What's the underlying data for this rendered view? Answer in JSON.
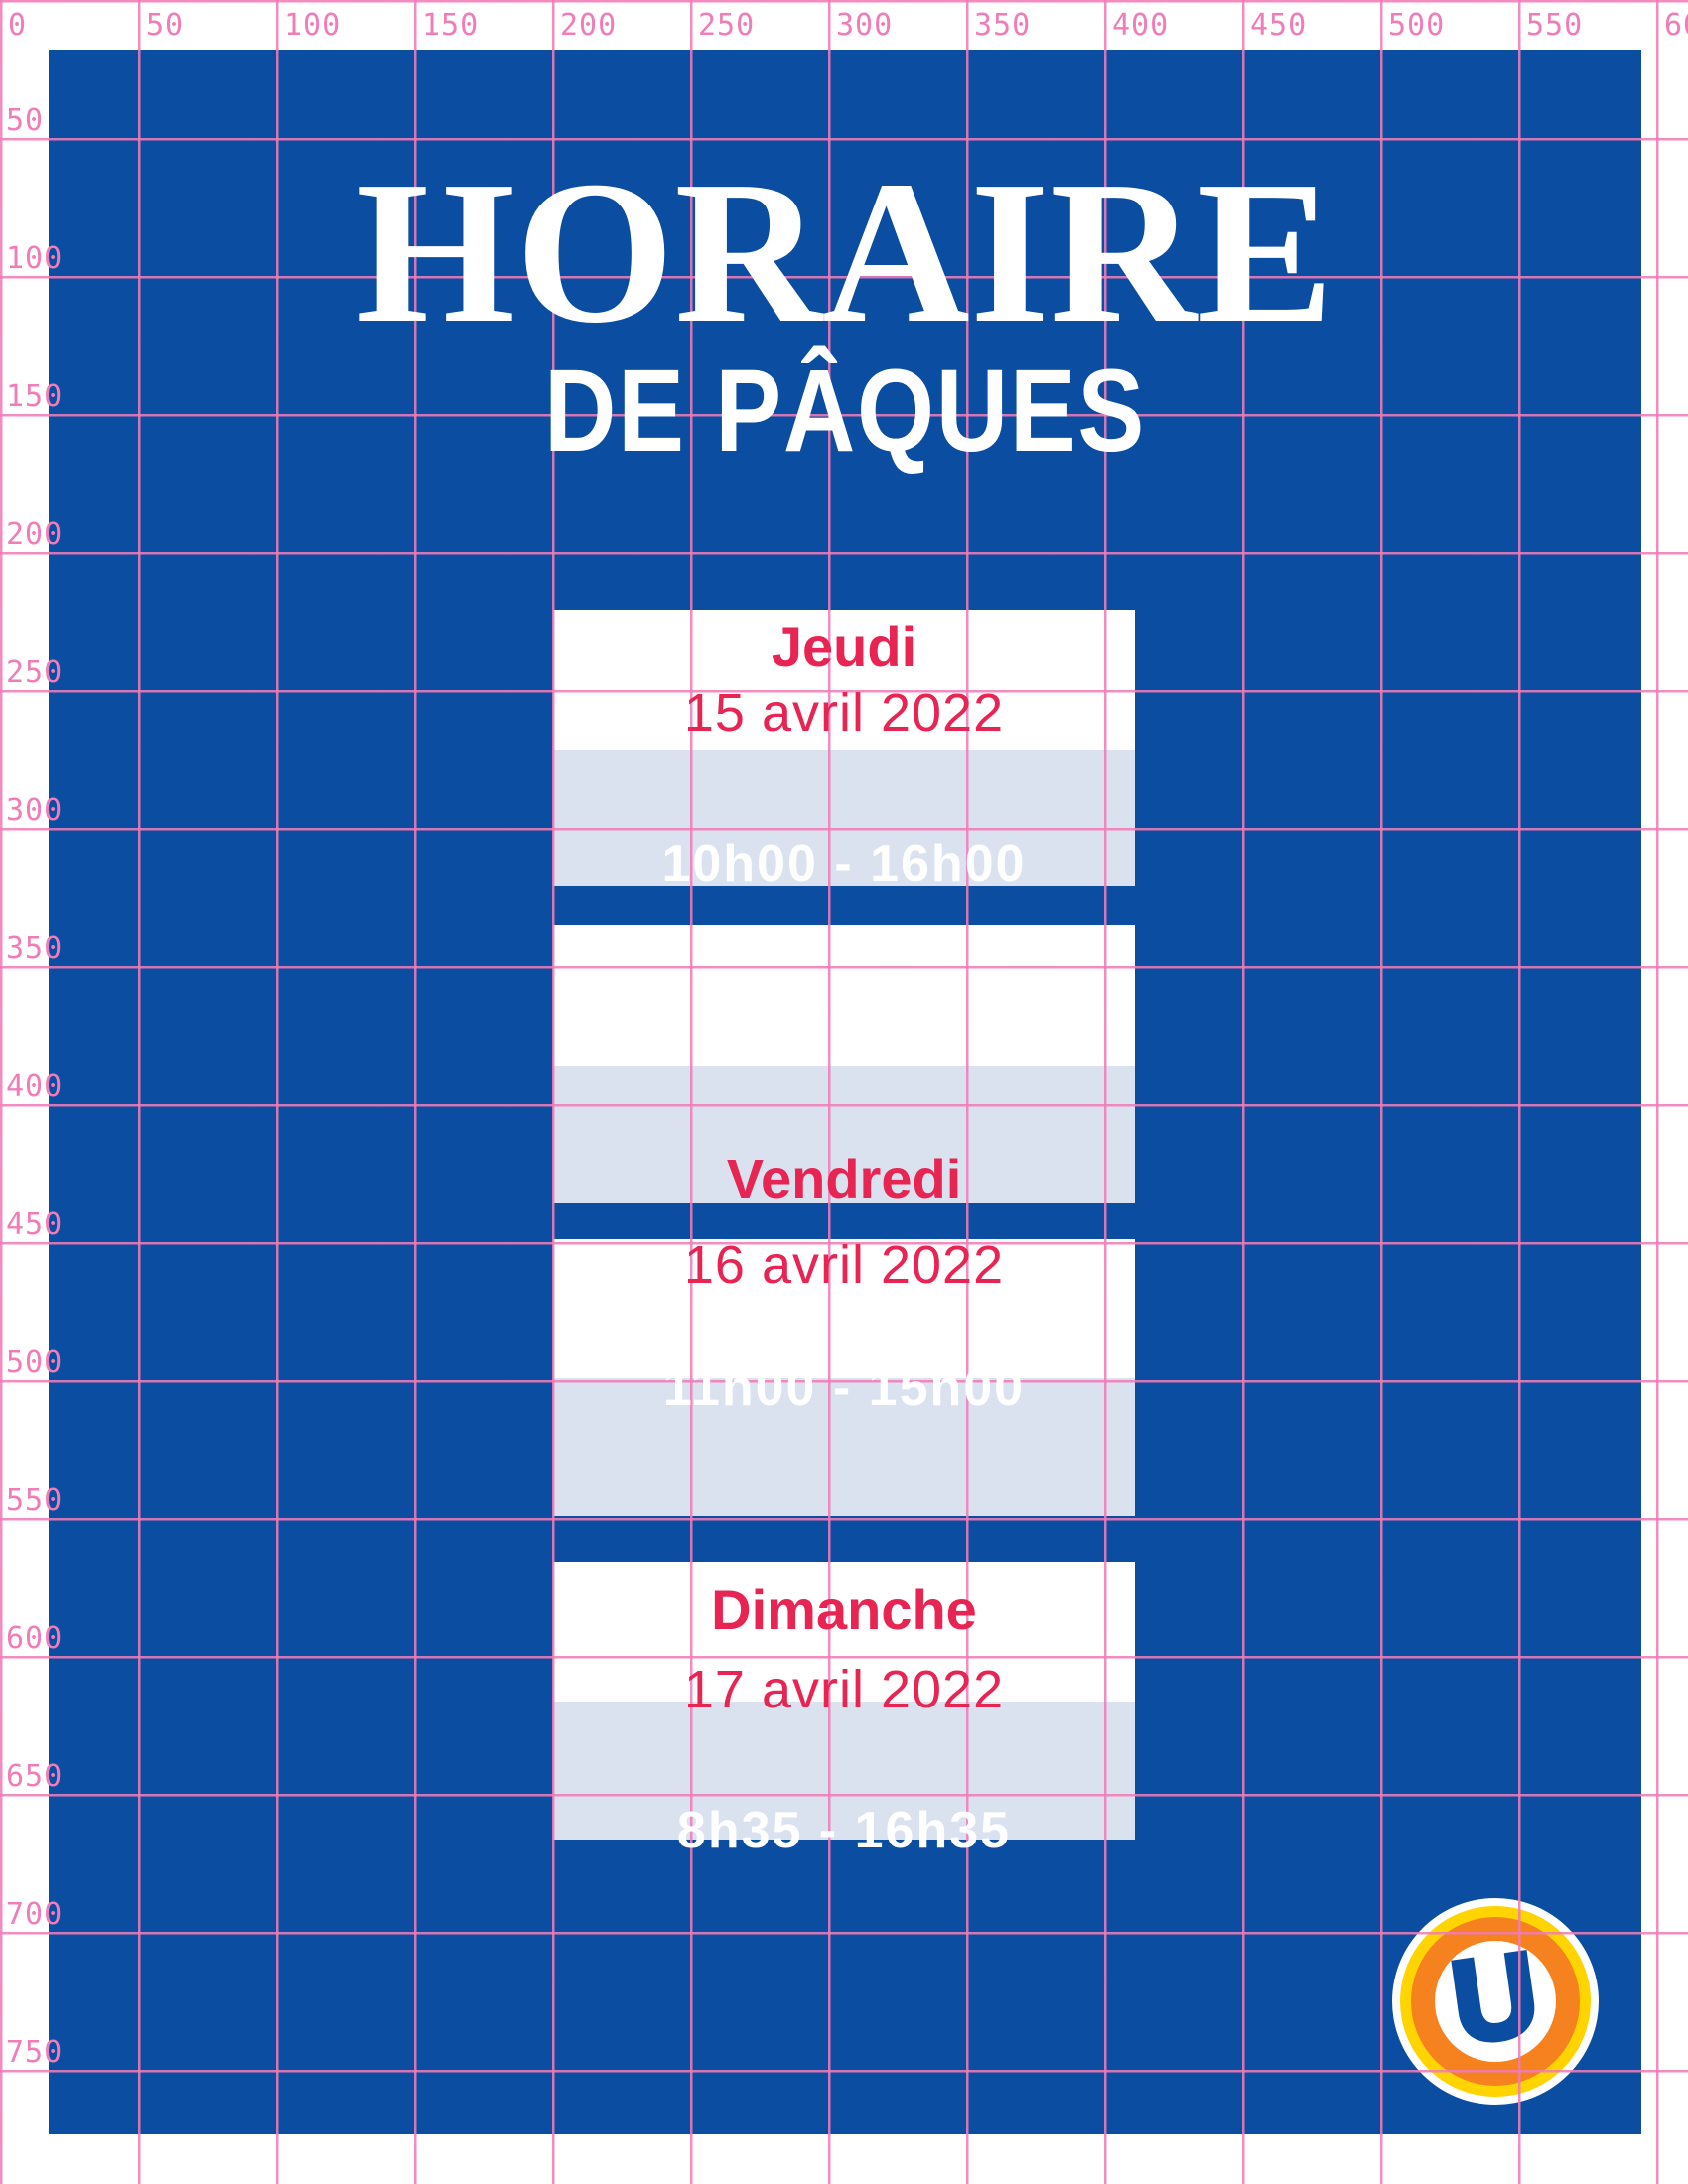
{
  "rulers": {
    "top": [
      "0",
      "50",
      "100",
      "150",
      "200",
      "250",
      "300",
      "350",
      "400",
      "450",
      "500",
      "550",
      "600"
    ],
    "left": [
      "50",
      "100",
      "150",
      "200",
      "250",
      "300",
      "350",
      "400",
      "450",
      "500",
      "550",
      "600",
      "650",
      "700",
      "750"
    ]
  },
  "poster": {
    "title_line1": "HORAIRE",
    "title_line2": "DE PÂQUES"
  },
  "days": [
    {
      "name": "Jeudi",
      "date": "15 avril 2022",
      "hours": "10h00 - 16h00"
    },
    {
      "name": "Vendredi",
      "date": "16 avril 2022",
      "hours": "11h00 - 15h00"
    },
    {
      "name": "Dimanche",
      "date": "17 avril 2022",
      "hours": "8h35 - 16h35"
    }
  ],
  "logo": {
    "letter": "U"
  },
  "colors": {
    "poster_blue": "#0A4DA1",
    "grid_pink": "#F17CB7",
    "accent_red": "#E82453",
    "band_blue": "#D9E2EE",
    "logo_orange": "#F5821F",
    "logo_yellow": "#FFD400"
  }
}
